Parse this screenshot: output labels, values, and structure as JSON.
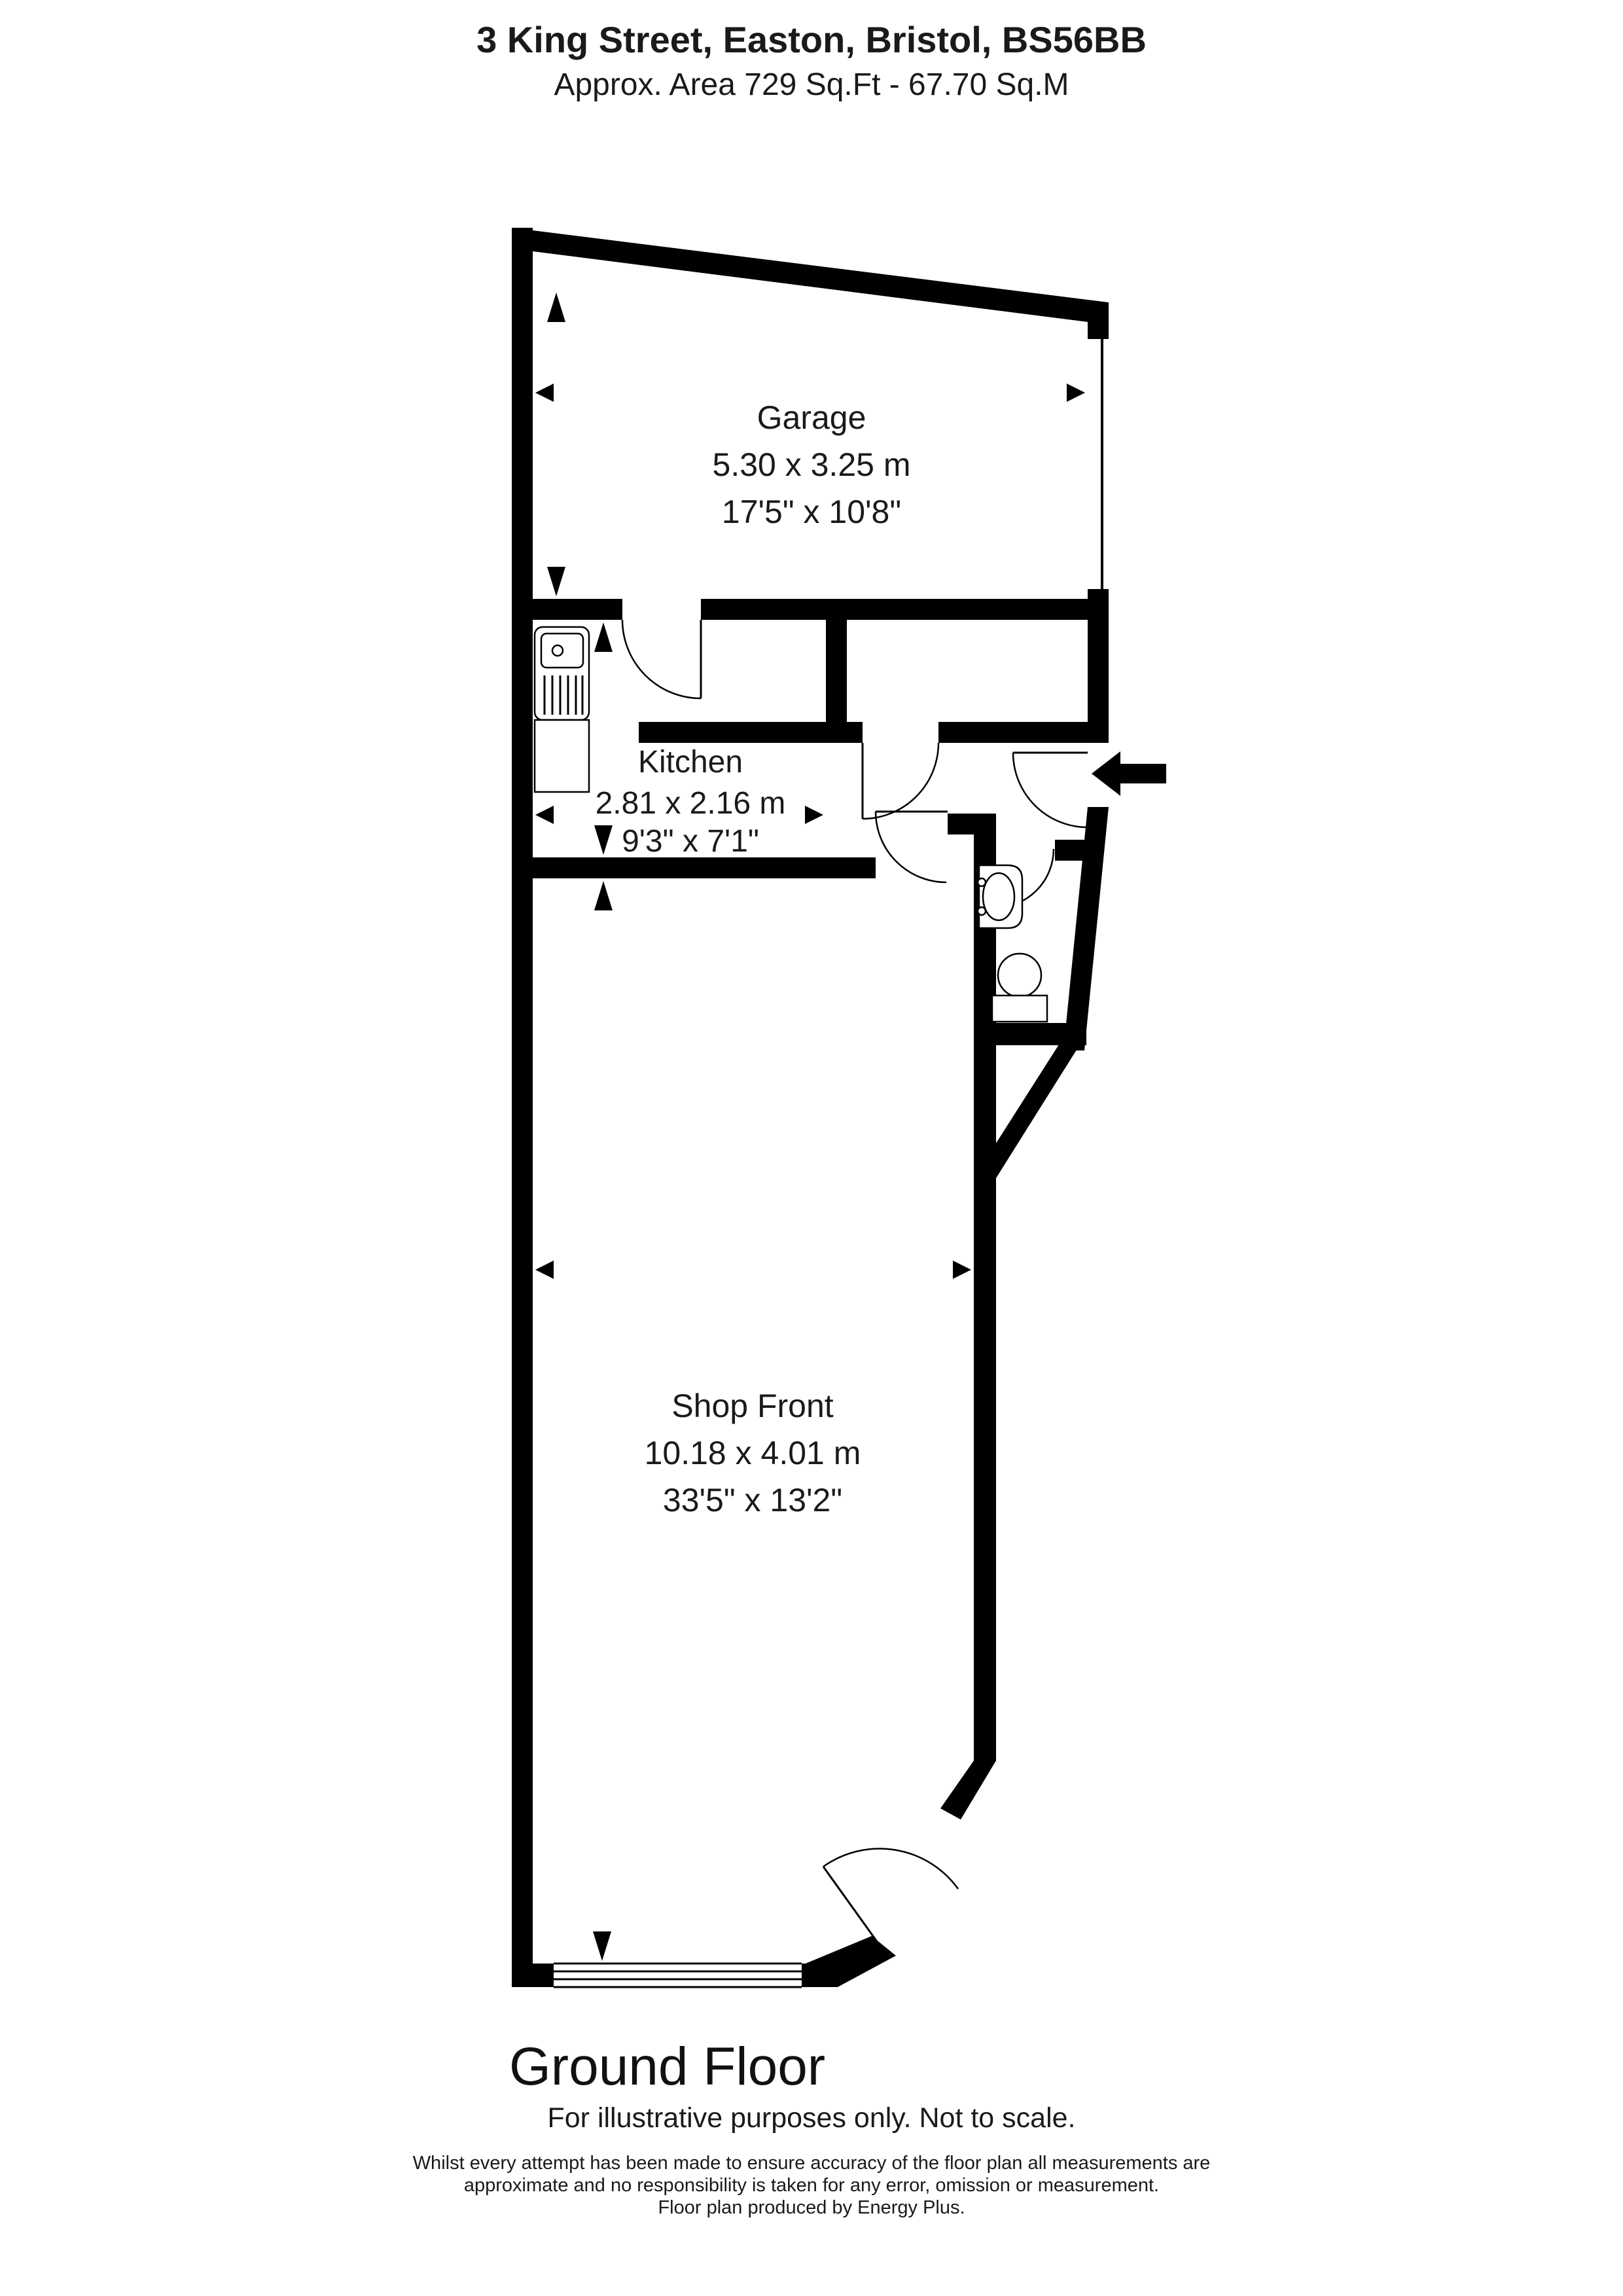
{
  "header": {
    "address": "3 King Street, Easton, Bristol, BS56BB",
    "area": "Approx. Area 729 Sq.Ft - 67.70 Sq.M"
  },
  "rooms": [
    {
      "id": "garage",
      "name": "Garage",
      "metric": "5.30 x 3.25 m",
      "imperial": "17'5\" x 10'8\""
    },
    {
      "id": "kitchen",
      "name": "Kitchen",
      "metric": "2.81 x 2.16 m",
      "imperial": "9'3\" x 7'1\""
    },
    {
      "id": "shop-front",
      "name": "Shop Front",
      "metric": "10.18 x 4.01 m",
      "imperial": "33'5\" x 13'2\""
    }
  ],
  "floor_label": "Ground Floor",
  "footer": {
    "notice": "For illustrative purposes only. Not to scale.",
    "disclaimer_line1": "Whilst every attempt has been made to ensure accuracy of the floor plan all measurements are",
    "disclaimer_line2": "approximate and no responsibility is taken for any error, omission or measurement.",
    "disclaimer_line3": "Floor plan produced by Energy Plus."
  },
  "icons": {
    "entry_arrow": "entry-direction-arrow",
    "measure_arrows": "dimension-arrowheads"
  },
  "colors": {
    "wall": "#000000",
    "background": "#ffffff",
    "text": "#1a1a1a"
  }
}
